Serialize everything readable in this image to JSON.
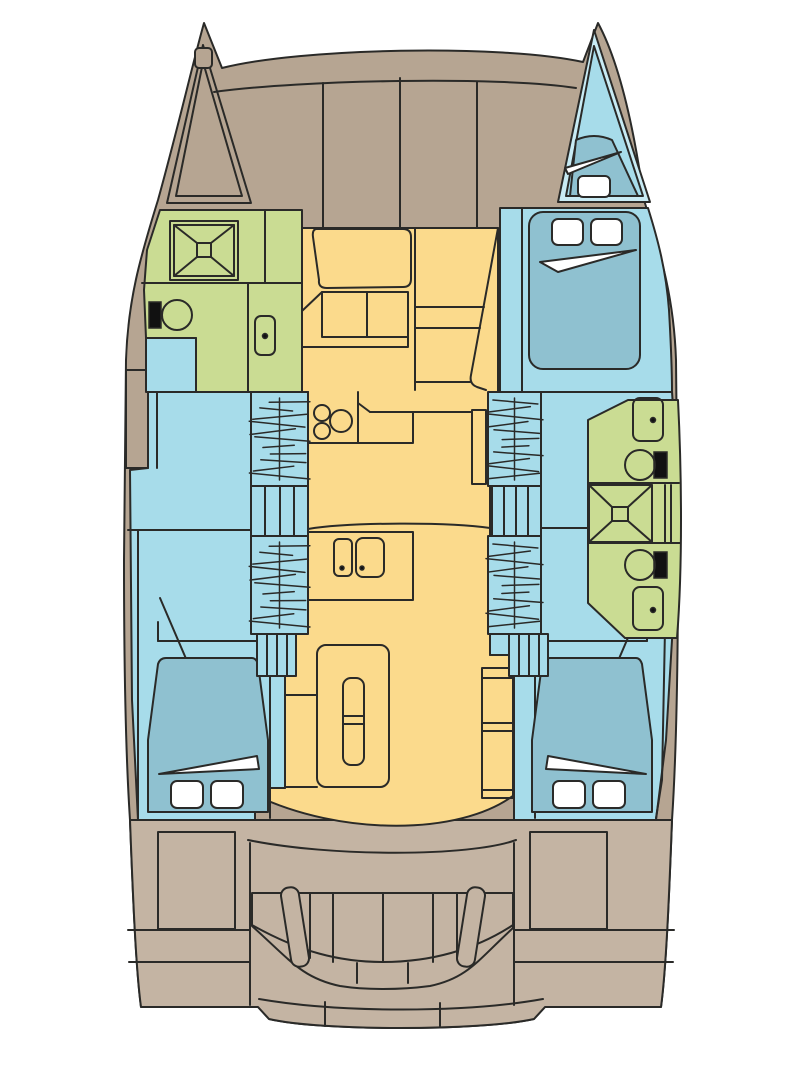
{
  "canvas": {
    "width": 805,
    "height": 1080
  },
  "palette": {
    "background": "#ffffff",
    "outline": "#2a2a28",
    "deck": "#b6a592",
    "cockpit": "#c4b4a3",
    "salon": "#fbda8c",
    "bath": "#cadc93",
    "cabin": "#a7dcea",
    "bed": "#8fc1d0",
    "rim": "#c8ebf4",
    "white": "#ffffff",
    "black": "#111111"
  }
}
